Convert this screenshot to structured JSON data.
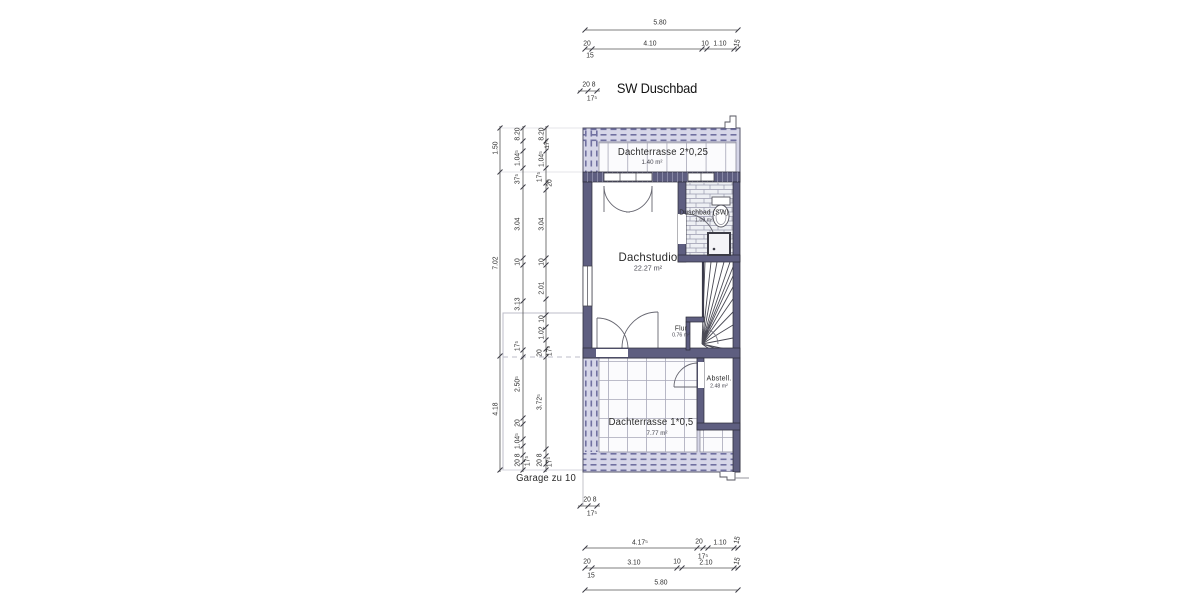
{
  "drawing_title": "SW Duschbad",
  "colors": {
    "wall": "#5e5e80",
    "wall_outline": "#2b2b38",
    "hatch_fill": "#d6d6e8",
    "hatch_dash": "#7070a0",
    "tile_fill": "#fbfbfd",
    "tile_line": "#a8a8b8",
    "dim_line": "#555555",
    "dim_text": "#2e2e2e",
    "reference_line": "#bcbcc8"
  },
  "rooms": [
    {
      "name": "dachterrasse-2",
      "label": "Dachterrasse 2*0,25",
      "area": "1.40 m²",
      "x": 663,
      "y": 153,
      "ax": 652,
      "ay": 163,
      "ls": 10,
      "as": 6.5
    },
    {
      "name": "dachstudio",
      "label": "Dachstudio",
      "area": "22.27 m²",
      "x": 648,
      "y": 257,
      "ax": 648,
      "ay": 268,
      "ls": 12,
      "as": 7.5
    },
    {
      "name": "duschbad",
      "label": "Duschbad (SW)",
      "area": "1.09 m²",
      "x": 704,
      "y": 213,
      "ax": 704,
      "ay": 221,
      "ls": 7,
      "as": 5.5
    },
    {
      "name": "flur",
      "label": "Flur",
      "area": "0.76 m²",
      "x": 681,
      "y": 329,
      "ax": 681,
      "ay": 336,
      "ls": 7,
      "as": 5.5
    },
    {
      "name": "abstellraum",
      "label": "Abstell.",
      "area": "2.48 m²",
      "x": 719,
      "y": 378,
      "ax": 719,
      "ay": 387,
      "ls": 7.5,
      "as": 5.5
    },
    {
      "name": "dachterrasse-1",
      "label": "Dachterrasse 1*0,5",
      "area": "7.77 m²",
      "x": 651,
      "y": 423,
      "ax": 657,
      "ay": 434,
      "ls": 10,
      "as": 6.5
    },
    {
      "name": "garage-reference",
      "label": "Garage zu 10",
      "area": "",
      "x": 546,
      "y": 479,
      "ax": 0,
      "ay": 0,
      "ls": 10,
      "as": 0
    }
  ],
  "dimensions": [
    {
      "t": "5.80",
      "x": 660,
      "y": 22
    },
    {
      "t": "20",
      "x": 587,
      "y": 43
    },
    {
      "t": "4.10",
      "x": 650,
      "y": 43
    },
    {
      "t": "10",
      "x": 705,
      "y": 43
    },
    {
      "t": "1.10",
      "x": 720,
      "y": 43
    },
    {
      "t": "15",
      "x": 737,
      "y": 43,
      "r": -75
    },
    {
      "t": "15",
      "x": 590,
      "y": 55
    },
    {
      "t": "20 8",
      "x": 589,
      "y": 84
    },
    {
      "t": "17⁵",
      "x": 592,
      "y": 98
    },
    {
      "t": "1.50",
      "x": 495,
      "y": 148,
      "r": -90
    },
    {
      "t": "7.02",
      "x": 495,
      "y": 263,
      "r": -90
    },
    {
      "t": "4.18",
      "x": 495,
      "y": 409,
      "r": -90
    },
    {
      "t": "8.20",
      "x": 517,
      "y": 134,
      "r": -90
    },
    {
      "t": "1.04⁵",
      "x": 517,
      "y": 158,
      "r": -90
    },
    {
      "t": "37⁵",
      "x": 517,
      "y": 179,
      "r": -90
    },
    {
      "t": "3.04",
      "x": 517,
      "y": 224,
      "r": -90
    },
    {
      "t": "10",
      "x": 517,
      "y": 262,
      "r": -90
    },
    {
      "t": "3.13",
      "x": 517,
      "y": 304,
      "r": -90
    },
    {
      "t": "17⁵",
      "x": 517,
      "y": 346,
      "r": -90
    },
    {
      "t": "2.50⁵",
      "x": 517,
      "y": 384,
      "r": -90
    },
    {
      "t": "20",
      "x": 517,
      "y": 423,
      "r": -90
    },
    {
      "t": "1.04⁵",
      "x": 517,
      "y": 441,
      "r": -90
    },
    {
      "t": "20 8",
      "x": 517,
      "y": 460,
      "r": -90
    },
    {
      "t": "17⁵",
      "x": 527,
      "y": 461,
      "r": -90
    },
    {
      "t": "8.20",
      "x": 541,
      "y": 134,
      "r": -90
    },
    {
      "t": "17⁵",
      "x": 548,
      "y": 144,
      "r": -90,
      "s": 6.5
    },
    {
      "t": "1.04⁵",
      "x": 541,
      "y": 159,
      "r": -90
    },
    {
      "t": "17⁵",
      "x": 539,
      "y": 177,
      "r": -90
    },
    {
      "t": "20",
      "x": 549,
      "y": 183,
      "r": -90
    },
    {
      "t": "3.04",
      "x": 541,
      "y": 224,
      "r": -90
    },
    {
      "t": "10",
      "x": 541,
      "y": 262,
      "r": -90
    },
    {
      "t": "2.01",
      "x": 541,
      "y": 288,
      "r": -90
    },
    {
      "t": "10",
      "x": 541,
      "y": 319,
      "r": -90
    },
    {
      "t": "1.02",
      "x": 541,
      "y": 333,
      "r": -90
    },
    {
      "t": "20",
      "x": 539,
      "y": 353,
      "r": -90
    },
    {
      "t": "17⁵",
      "x": 549,
      "y": 351,
      "r": -90
    },
    {
      "t": "3.72⁵",
      "x": 539,
      "y": 402,
      "r": -90
    },
    {
      "t": "20 8",
      "x": 539,
      "y": 460,
      "r": -90
    },
    {
      "t": "17⁵",
      "x": 549,
      "y": 462,
      "r": -90
    },
    {
      "t": "20 8",
      "x": 590,
      "y": 499
    },
    {
      "t": "17⁵",
      "x": 592,
      "y": 513
    },
    {
      "t": "4.17⁵",
      "x": 640,
      "y": 542
    },
    {
      "t": "20",
      "x": 699,
      "y": 541
    },
    {
      "t": "1.10",
      "x": 720,
      "y": 542
    },
    {
      "t": "15",
      "x": 737,
      "y": 540,
      "r": -75
    },
    {
      "t": "17⁵",
      "x": 703,
      "y": 556
    },
    {
      "t": "20",
      "x": 587,
      "y": 561
    },
    {
      "t": "3.10",
      "x": 634,
      "y": 562
    },
    {
      "t": "10",
      "x": 677,
      "y": 561
    },
    {
      "t": "2.10",
      "x": 706,
      "y": 562
    },
    {
      "t": "15",
      "x": 737,
      "y": 561,
      "r": -75
    },
    {
      "t": "15",
      "x": 591,
      "y": 575
    },
    {
      "t": "5.80",
      "x": 661,
      "y": 582
    }
  ]
}
